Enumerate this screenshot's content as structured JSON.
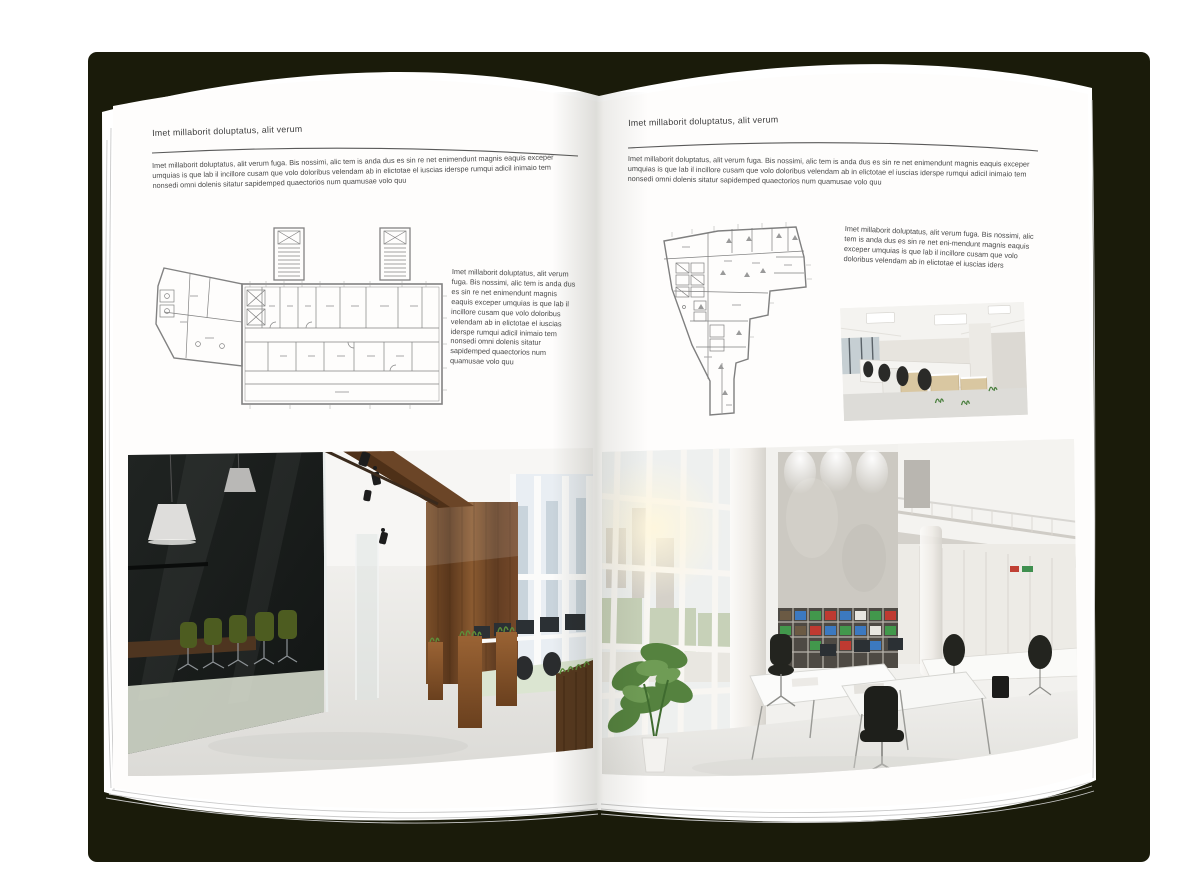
{
  "canvas": {
    "shadow_blob_color": "#1a1b0a",
    "page_color": "#fefdfc",
    "backdrop_color": "#ffffff",
    "rule_color": "#5a5a5a"
  },
  "spread": {
    "left_page": {
      "header": "Imet millaborit doluptatus, alit verum",
      "intro": "Imet millaborit doluptatus, alit verum fuga. Bis nossimi, alic tem is anda dus es sin re net enimendunt magnis eaquis exceper umquias is que lab il incillore cusam que volo doloribus velendam ab in elictotae el iuscias iderspe rumqui adicil inimaio tem nonsedi omni dolenis sitatur sapidemped quaectorios num quamusae volo quu",
      "side_text": "Imet millaborit doluptatus, alit verum fuga. Bis nossimi, alic tem is anda dus es sin re net enimendunt magnis eaquis exceper umquias is que lab il incillore cusam que volo doloribus velendam ab in elictotae el iuscias iderspe rumqui adicil inimaio tem nonsedi omni dolenis sitatur sapidemped quaectorios num quamusae volo quu",
      "figures": {
        "floor_plan": "architectural-floor-plan-wide-block",
        "photo": "dark-wood-and-glass-office-interior"
      }
    },
    "right_page": {
      "header": "Imet millaborit doluptatus, alit verum",
      "intro": "Imet millaborit doluptatus, alit verum fuga. Bis nossimi, alic tem is anda dus es sin re net enimendunt magnis eaquis exceper umquias is que lab il incillore cusam que volo doloribus velendam ab in elictotae el iuscias iderspe rumqui adicil inimaio tem nonsedi omni dolenis sitatur sapidemped quaectorios num quamusae volo quu",
      "side_text": "Imet millaborit doluptatus, alit verum fuga. Bis nossimi, alic tem is anda dus es sin re net eni-mendunt magnis eaquis exceper umquias is que lab il incillore cusam que volo doloribus velendam ab in elictotae el iuscias iders",
      "figures": {
        "floor_plan": "architectural-floor-plan-irregular-block",
        "photo_small": "white-office-workstations",
        "photo_large": "bright-open-plan-office"
      }
    }
  }
}
